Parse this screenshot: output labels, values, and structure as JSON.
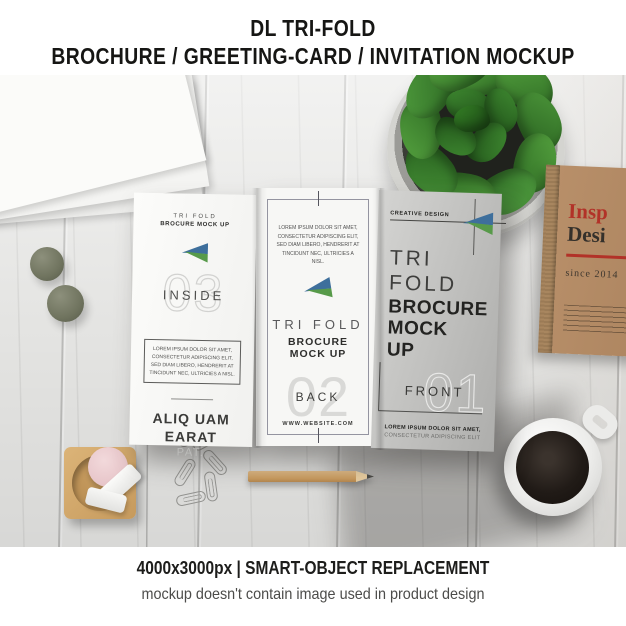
{
  "page": {
    "title_line1": "DL TRI-FOLD",
    "title_line2": "BROCHURE / GREETING-CARD / INVITATION MOCKUP",
    "footer_line1": "4000x3000px | SMART-OBJECT REPLACEMENT",
    "footer_line2": "mockup doesn't contain image used in product design"
  },
  "brochure": {
    "logo": {
      "name": "triangle-logo",
      "blue": "#3e6f9c",
      "green": "#579a49"
    },
    "inside": {
      "header_small": "TRI FOLD",
      "header_bold": "BROCURE MOCK UP",
      "number": "03",
      "label": "INSIDE",
      "box_text": "LOREM IPSUM DOLOR SIT AMET, CONSECTETUR ADIPISCING ELIT, SED DIAM LIBERO, HENDRERIT AT TINCIDUNT NEC, ULTRICIES A NISL.",
      "headline_line1": "ALIQ UAM",
      "headline_line2": "EARAT",
      "headline_sub": "PAT."
    },
    "back": {
      "body_text": "LOREM IPSUM DOLOR SIT AMET, CONSECTETUR ADIPISCING ELIT, SED DIAM LIBERO, HENDRERIT AT TINCIDUNT NEC, ULTRICIES A NISL.",
      "title_small": "TRI FOLD",
      "title_bold": "BROCURE MOCK UP",
      "number": "02",
      "label": "BACK",
      "website": "WWW.WEBSITE.COM"
    },
    "front": {
      "tagline": "CREATIVE DESIGN",
      "title_thin_line1": "TRI",
      "title_thin_line2": "FOLD",
      "title_bold_line1": "BROCURE",
      "title_bold_line2": "MOCK",
      "title_bold_line3": "UP",
      "number": "01",
      "label": "FRONT",
      "footer_bold": "LOREM IPSUM DOLOR SIT AMET,",
      "footer_light": "CONSECTETUR ADIPISCING ELIT"
    }
  },
  "book": {
    "title_line1": "Insp",
    "title_line2": "Desi",
    "subtitle": "since 2014",
    "accent_color": "#b23228"
  },
  "scene": {
    "desk_color": "#e8e8e6",
    "leaf_color": "#3c7a31",
    "kraft_color": "#b48c63",
    "coffee_color": "#1e1916",
    "items": [
      "stacked-papers",
      "basil-plant",
      "kraft-notebook",
      "tri-fold-brochure",
      "green-balls",
      "wooden-tray-eraser",
      "paperclips",
      "pencil",
      "coffee-mug"
    ]
  }
}
